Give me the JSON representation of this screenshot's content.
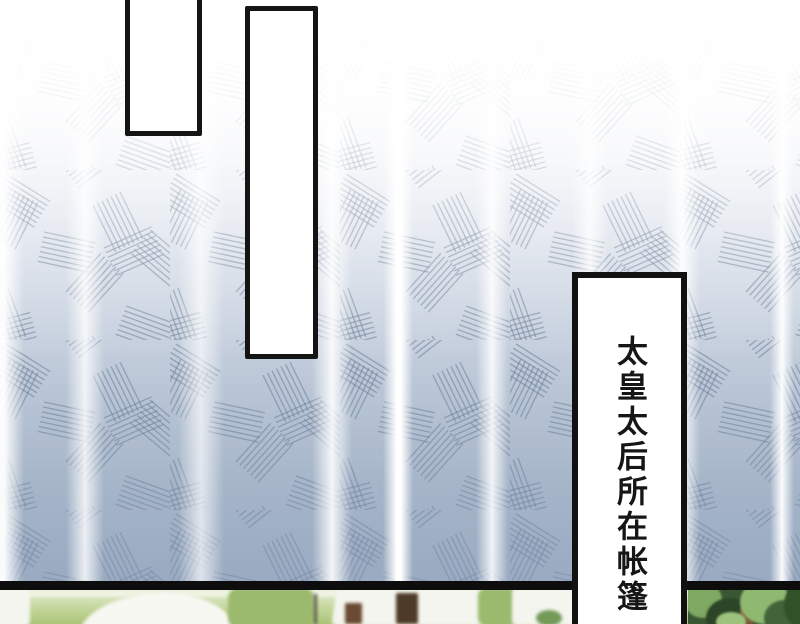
{
  "comic": {
    "caption": {
      "text": "太皇太后所在帐篷"
    },
    "speech_bubbles": [
      {
        "text": ""
      },
      {
        "text": ""
      }
    ],
    "colors": {
      "panel_border": "#111111",
      "curtain_top": "#ffffff",
      "curtain_bottom": "#a5b4c8",
      "hatch_line": "#64768f",
      "grass": "#aac479",
      "tent_white": "#f7f8f2",
      "tent_door_brown": "#4e3a28",
      "foliage_dark": "#2c4527",
      "foliage_light": "#8fb871",
      "trunk_brown": "#8a6a45"
    }
  }
}
